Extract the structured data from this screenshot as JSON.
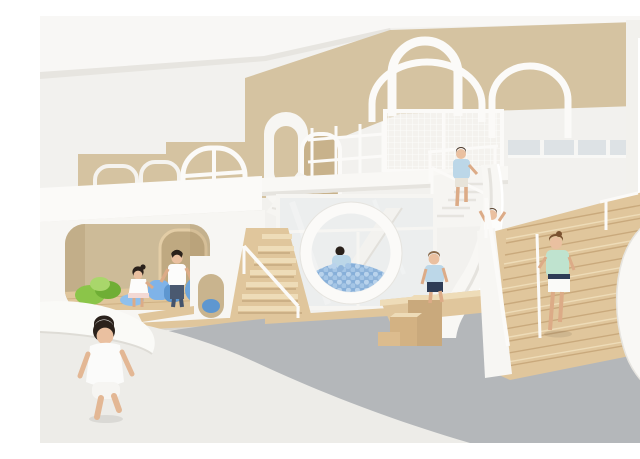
{
  "photo": {
    "alt": "Bright kindergarten playroom with sculptural white play structures: a two-storey play cube with a rounded opening and arched doorway, a giant circular window revealing a blue ball pit with an internal slide, a netted mezzanine cage under white arch frames, white slides, timber block steps and a wide oak staircase with a curved white balustrade; eight children play throughout; sand-coloured wall panels above white walls, clerestory windows and a grey vinyl floor.",
    "scene": "children-indoor-playground"
  },
  "colors": {
    "wall": "#f2f1ee",
    "ceiling": "#f8f7f5",
    "shade": "#e7e5e0",
    "tan": "#d5c3a1",
    "tanDeep": "#c8b28b",
    "nookBack": "#cdbb98",
    "white": "#fbfaf8",
    "wood": "#e0c69c",
    "woodDark": "#c9a97c",
    "woodLight": "#eedcb8",
    "floorGray": "#b4b7ba",
    "floorWhite": "#edece8",
    "glass": "#eceeee",
    "ballBlue": "#8fb4da",
    "ballBlueLight": "#b9d3ec",
    "foamGreen": "#8bc549",
    "foamGreenDark": "#6fae35",
    "foamBlue": "#7fb3e8",
    "foamBlueDark": "#5e97d0",
    "skin": "#eac0a0",
    "hairDark": "#2a211b",
    "hairBrown": "#7a5230",
    "shirtBlue": "#bcd7e8",
    "mint": "#bfe3cf",
    "navy": "#2e3c56",
    "denim": "#4a5970",
    "cloth": "#fcfcfb"
  },
  "children": [
    {
      "id": "toddler-running",
      "outfit": "white t-shirt and shorts",
      "location": "foreground floor"
    },
    {
      "id": "girl-in-nook",
      "outfit": "white dress",
      "location": "play cube nook"
    },
    {
      "id": "boy-in-nook",
      "outfit": "white t-shirt and jeans",
      "location": "play cube nook"
    },
    {
      "id": "boy-on-white-stairs",
      "outfit": "blue t-shirt",
      "location": "mezzanine stairs"
    },
    {
      "id": "child-in-ball-pit",
      "outfit": "blue t-shirt",
      "location": "ball pit behind circular window"
    },
    {
      "id": "child-climbing-slide",
      "outfit": "white t-shirt",
      "location": "beside big slide"
    },
    {
      "id": "boy-on-timber-blocks",
      "outfit": "blue t-shirt and navy shorts",
      "location": "timber block steps"
    },
    {
      "id": "girl-on-oak-stairs",
      "outfit": "mint t-shirt and navy-white skirt",
      "location": "main oak staircase"
    }
  ],
  "elements": {
    "left_cube": "two-storey white play cube with rounded opening",
    "ball_pit_window": "circular ball-pit window",
    "net_cage": "netted mezzanine cage",
    "arches": "white arch frames",
    "big_slide": "white slide",
    "oak_stairs": "wide oak staircase",
    "balustrade": "curved white balustrade",
    "clerestory": "clerestory windows"
  }
}
